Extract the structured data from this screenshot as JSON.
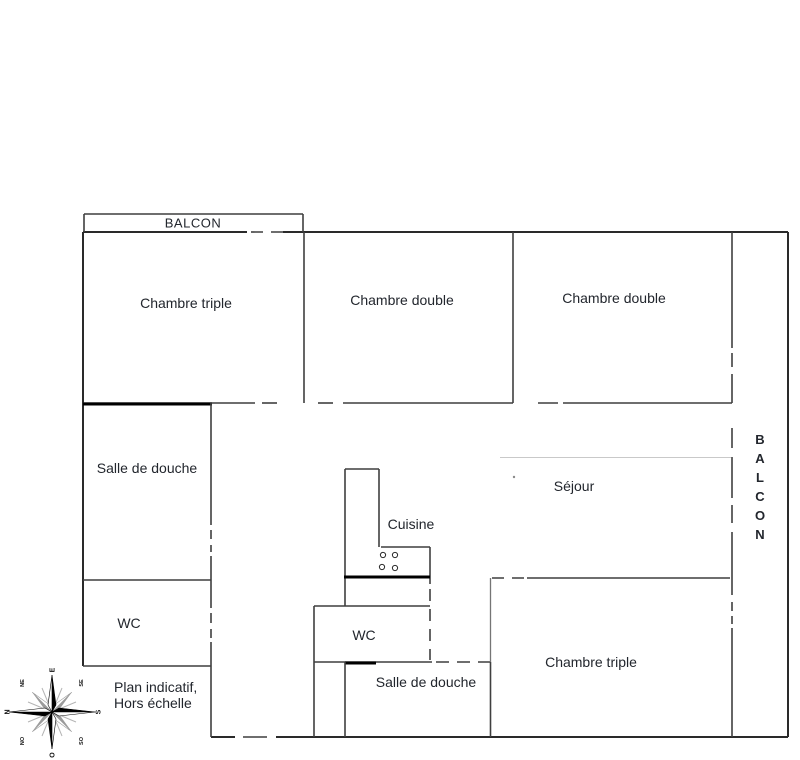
{
  "rooms": {
    "chambre_triple_top": "Chambre triple",
    "chambre_double_mid": "Chambre double",
    "chambre_double_right": "Chambre double",
    "salle_de_douche_left": "Salle de douche",
    "wc_left": "WC",
    "cuisine": "Cuisine",
    "sejour": "Séjour",
    "wc_mid": "WC",
    "salle_de_douche_bottom": "Salle de douche",
    "chambre_triple_bottom": "Chambre triple"
  },
  "balconies": {
    "top": "BALCON",
    "right": "BALCON"
  },
  "note": {
    "line1": "Plan indicatif,",
    "line2": "Hors échelle"
  },
  "compass": {
    "north": "N",
    "south": "S",
    "east": "E",
    "west": "O",
    "northeast": "NE",
    "southeast": "SE",
    "northwest": "NO",
    "southwest": "SO"
  },
  "colors": {
    "wall": "#3f3f3f",
    "wall-dark": "#2a2a2a",
    "wall-gray": "#757575",
    "wall-bold": "#000000",
    "wall-faint": "#c9c9c9",
    "text": "#22262d"
  }
}
